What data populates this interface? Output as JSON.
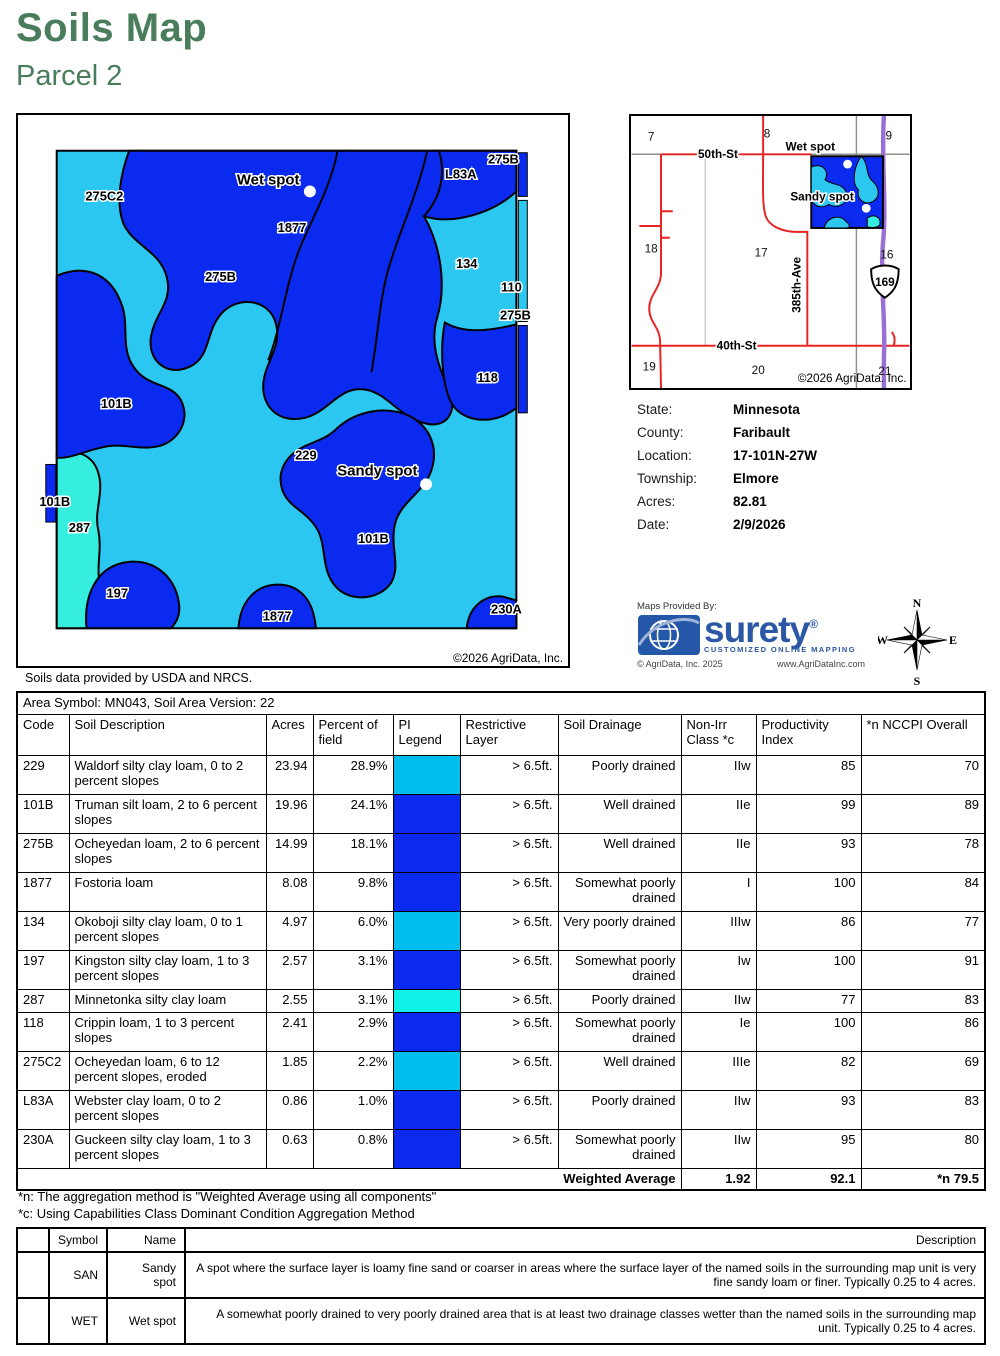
{
  "page": {
    "title": "Soils Map",
    "subtitle": "Parcel 2"
  },
  "colors": {
    "title_green": "#4a7d5c",
    "map_cyan": "#2cc7f0",
    "map_blue": "#0a2af0",
    "map_aqua": "#35eedd",
    "legend_cyan": "#00bfef",
    "legend_blue": "#0a2af0",
    "legend_aqua": "#0ff0e8",
    "road_red": "#e82222",
    "highway_purple": "#9a6fd6",
    "surety_blue": "#2b57a5"
  },
  "map": {
    "attribution": "©2026 AgriData, Inc.",
    "source_note": "Soils data provided by USDA and NRCS.",
    "labels": [
      {
        "text": "275C2",
        "x": 87,
        "y": 86,
        "size": 13
      },
      {
        "text": "Wet spot",
        "x": 252,
        "y": 70,
        "size": 15
      },
      {
        "text": "1877",
        "x": 276,
        "y": 118,
        "size": 13
      },
      {
        "text": "275B",
        "x": 204,
        "y": 167,
        "size": 13
      },
      {
        "text": "L83A",
        "x": 446,
        "y": 64,
        "size": 13
      },
      {
        "text": "275B",
        "x": 489,
        "y": 49,
        "size": 13
      },
      {
        "text": "134",
        "x": 452,
        "y": 154,
        "size": 13
      },
      {
        "text": "110",
        "x": 497,
        "y": 178,
        "size": 13
      },
      {
        "text": "275B",
        "x": 501,
        "y": 206,
        "size": 13
      },
      {
        "text": "118",
        "x": 473,
        "y": 269,
        "size": 13
      },
      {
        "text": "101B",
        "x": 99,
        "y": 295,
        "size": 13
      },
      {
        "text": "229",
        "x": 290,
        "y": 347,
        "size": 13
      },
      {
        "text": "Sandy spot",
        "x": 362,
        "y": 363,
        "size": 15
      },
      {
        "text": "101B",
        "x": 37,
        "y": 394,
        "size": 13
      },
      {
        "text": "287",
        "x": 62,
        "y": 420,
        "size": 13
      },
      {
        "text": "101B",
        "x": 358,
        "y": 431,
        "size": 13
      },
      {
        "text": "197",
        "x": 100,
        "y": 486,
        "size": 13
      },
      {
        "text": "1877",
        "x": 261,
        "y": 509,
        "size": 13
      },
      {
        "text": "230A",
        "x": 492,
        "y": 502,
        "size": 13
      }
    ],
    "spots": [
      {
        "x": 294,
        "y": 77
      },
      {
        "x": 411,
        "y": 372
      }
    ]
  },
  "locator": {
    "attribution": "©2026 AgriData. Inc.",
    "highway_shield": "169",
    "sections": [
      {
        "text": "7",
        "x": 20,
        "y": 25
      },
      {
        "text": "8",
        "x": 138,
        "y": 22
      },
      {
        "text": "9",
        "x": 262,
        "y": 24
      },
      {
        "text": "18",
        "x": 20,
        "y": 139
      },
      {
        "text": "17",
        "x": 132,
        "y": 143
      },
      {
        "text": "16",
        "x": 260,
        "y": 145
      },
      {
        "text": "19",
        "x": 18,
        "y": 259
      },
      {
        "text": "20",
        "x": 129,
        "y": 263
      },
      {
        "text": "21",
        "x": 258,
        "y": 264
      }
    ],
    "roads": [
      {
        "text": "50th-St",
        "x": 88,
        "y": 43,
        "rotate": 0
      },
      {
        "text": "Wet spot",
        "x": 182,
        "y": 35,
        "rotate": 0
      },
      {
        "text": "Sandy spot",
        "x": 194,
        "y": 86,
        "rotate": 0
      },
      {
        "text": "40th-St",
        "x": 107,
        "y": 238,
        "rotate": 0
      },
      {
        "text": "385th-Ave",
        "x": 172,
        "y": 172,
        "rotate": -90
      }
    ],
    "spots": [
      {
        "x": 220,
        "y": 49
      },
      {
        "x": 239,
        "y": 94
      }
    ]
  },
  "info": {
    "rows": [
      {
        "label": "State:",
        "value": "Minnesota"
      },
      {
        "label": "County:",
        "value": "Faribault"
      },
      {
        "label": "Location:",
        "value": "17-101N-27W"
      },
      {
        "label": "Township:",
        "value": "Elmore"
      },
      {
        "label": "Acres:",
        "value": "82.81"
      },
      {
        "label": "Date:",
        "value": "2/9/2026"
      }
    ]
  },
  "branding": {
    "maps_provided_by": "Maps Provided By:",
    "logo_text": "surety",
    "logo_reg": "®",
    "tagline": "CUSTOMIZED ONLINE MAPPING",
    "copyright": "© AgriData, Inc. 2025",
    "website": "www.AgriDataInc.com"
  },
  "compass": {
    "n": "N",
    "s": "S",
    "e": "E",
    "w": "W"
  },
  "soil_table": {
    "area_header": "Area Symbol: MN043, Soil Area Version: 22",
    "columns": [
      "Code",
      "Soil Description",
      "Acres",
      "Percent of field",
      "PI Legend",
      "Restrictive Layer",
      "Soil Drainage",
      "Non-Irr Class *c",
      "Productivity Index",
      "*n NCCPI Overall"
    ],
    "rows": [
      {
        "code": "229",
        "description": "Waldorf silty clay loam, 0 to 2 percent slopes",
        "acres": "23.94",
        "percent": "28.9%",
        "legend_color": "#00bfef",
        "restrictive_layer": "> 6.5ft.",
        "soil_drainage": "Poorly drained",
        "non_irr_class": "IIw",
        "productivity_index": "85",
        "nccpi_overall": "70"
      },
      {
        "code": "101B",
        "description": "Truman silt loam, 2 to 6 percent slopes",
        "acres": "19.96",
        "percent": "24.1%",
        "legend_color": "#0a2af0",
        "restrictive_layer": "> 6.5ft.",
        "soil_drainage": "Well drained",
        "non_irr_class": "IIe",
        "productivity_index": "99",
        "nccpi_overall": "89"
      },
      {
        "code": "275B",
        "description": "Ocheyedan loam, 2 to 6 percent slopes",
        "acres": "14.99",
        "percent": "18.1%",
        "legend_color": "#0a2af0",
        "restrictive_layer": "> 6.5ft.",
        "soil_drainage": "Well drained",
        "non_irr_class": "IIe",
        "productivity_index": "93",
        "nccpi_overall": "78"
      },
      {
        "code": "1877",
        "description": "Fostoria loam",
        "acres": "8.08",
        "percent": "9.8%",
        "legend_color": "#0a2af0",
        "restrictive_layer": "> 6.5ft.",
        "soil_drainage": "Somewhat poorly drained",
        "non_irr_class": "I",
        "productivity_index": "100",
        "nccpi_overall": "84"
      },
      {
        "code": "134",
        "description": "Okoboji silty clay loam, 0 to 1 percent slopes",
        "acres": "4.97",
        "percent": "6.0%",
        "legend_color": "#00bfef",
        "restrictive_layer": "> 6.5ft.",
        "soil_drainage": "Very poorly drained",
        "non_irr_class": "IIIw",
        "productivity_index": "86",
        "nccpi_overall": "77"
      },
      {
        "code": "197",
        "description": "Kingston silty clay loam, 1 to 3 percent slopes",
        "acres": "2.57",
        "percent": "3.1%",
        "legend_color": "#0a2af0",
        "restrictive_layer": "> 6.5ft.",
        "soil_drainage": "Somewhat poorly drained",
        "non_irr_class": "Iw",
        "productivity_index": "100",
        "nccpi_overall": "91"
      },
      {
        "code": "287",
        "description": "Minnetonka silty clay loam",
        "acres": "2.55",
        "percent": "3.1%",
        "legend_color": "#0ff0e8",
        "restrictive_layer": "> 6.5ft.",
        "soil_drainage": "Poorly drained",
        "non_irr_class": "IIw",
        "productivity_index": "77",
        "nccpi_overall": "83"
      },
      {
        "code": "118",
        "description": "Crippin loam, 1 to 3 percent slopes",
        "acres": "2.41",
        "percent": "2.9%",
        "legend_color": "#0a2af0",
        "restrictive_layer": "> 6.5ft.",
        "soil_drainage": "Somewhat poorly drained",
        "non_irr_class": "Ie",
        "productivity_index": "100",
        "nccpi_overall": "86"
      },
      {
        "code": "275C2",
        "description": "Ocheyedan loam, 6 to 12 percent slopes, eroded",
        "acres": "1.85",
        "percent": "2.2%",
        "legend_color": "#00bfef",
        "restrictive_layer": "> 6.5ft.",
        "soil_drainage": "Well drained",
        "non_irr_class": "IIIe",
        "productivity_index": "82",
        "nccpi_overall": "69"
      },
      {
        "code": "L83A",
        "description": "Webster clay loam, 0 to 2 percent slopes",
        "acres": "0.86",
        "percent": "1.0%",
        "legend_color": "#0a2af0",
        "restrictive_layer": "> 6.5ft.",
        "soil_drainage": "Poorly drained",
        "non_irr_class": "IIw",
        "productivity_index": "93",
        "nccpi_overall": "83"
      },
      {
        "code": "230A",
        "description": "Guckeen silty clay loam, 1 to 3 percent slopes",
        "acres": "0.63",
        "percent": "0.8%",
        "legend_color": "#0a2af0",
        "restrictive_layer": "> 6.5ft.",
        "soil_drainage": "Somewhat poorly drained",
        "non_irr_class": "IIw",
        "productivity_index": "95",
        "nccpi_overall": "80"
      }
    ],
    "weighted_average": {
      "label": "Weighted Average",
      "non_irr_class": "1.92",
      "productivity_index": "92.1",
      "nccpi_overall": "*n 79.5"
    }
  },
  "footnotes": [
    "*n: The aggregation method is \"Weighted Average using all components\"",
    "*c: Using Capabilities Class Dominant Condition Aggregation Method"
  ],
  "legend_table": {
    "columns": [
      "",
      "Symbol",
      "Name",
      "Description"
    ],
    "rows": [
      {
        "symbol": "SAN",
        "name": "Sandy spot",
        "description": "A spot where the surface layer is loamy fine sand or coarser in areas where the surface layer of the named soils in the surrounding map unit is very fine sandy loam or finer. Typically 0.25 to 4 acres."
      },
      {
        "symbol": "WET",
        "name": "Wet spot",
        "description": "A somewhat poorly drained to very poorly drained area that is at least two drainage classes wetter than the named soils in the surrounding map unit. Typically 0.25 to 4 acres."
      }
    ]
  }
}
